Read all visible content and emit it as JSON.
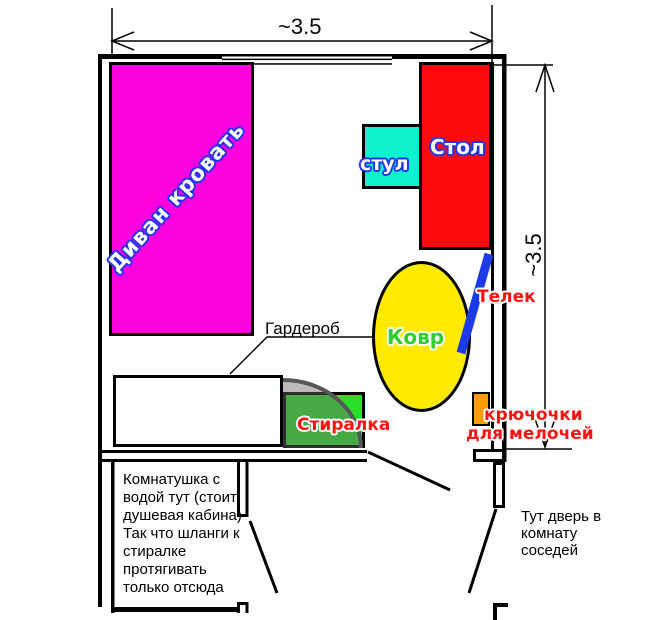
{
  "dimensions": {
    "top": "~3.5",
    "right": "~3.5"
  },
  "labels": {
    "bed": "Диван кровать",
    "table": "Стол",
    "chair": "стул",
    "carpet": "Ковр",
    "tv": "Телек",
    "washer": "Стиралка",
    "hooks_line1": "крючочки",
    "hooks_line2": "для мелочей",
    "wardrobe": "Гардероб"
  },
  "notes": {
    "utility_lines": [
      "Комнатушка с",
      "водой тут (стоит",
      "душевая кабина)",
      "Так что шланги к",
      "стиралке",
      "протягивать",
      "только отсюда"
    ],
    "neighbor_lines": [
      "Тут дверь в",
      "комнату",
      "соседей"
    ]
  },
  "colors": {
    "bed": "#FF00E1",
    "table": "#FF0A0A",
    "chair": "#0DF2CC",
    "carpet": "#FFEA00",
    "carpet_label": "#2FCF2F",
    "tv": "#1C3BE8",
    "washer": "#2ADF2A",
    "hooks": "#FF9C00",
    "red_label": "#FF1212",
    "blue_label_outline": "#2334EE",
    "wall": "#000000"
  }
}
